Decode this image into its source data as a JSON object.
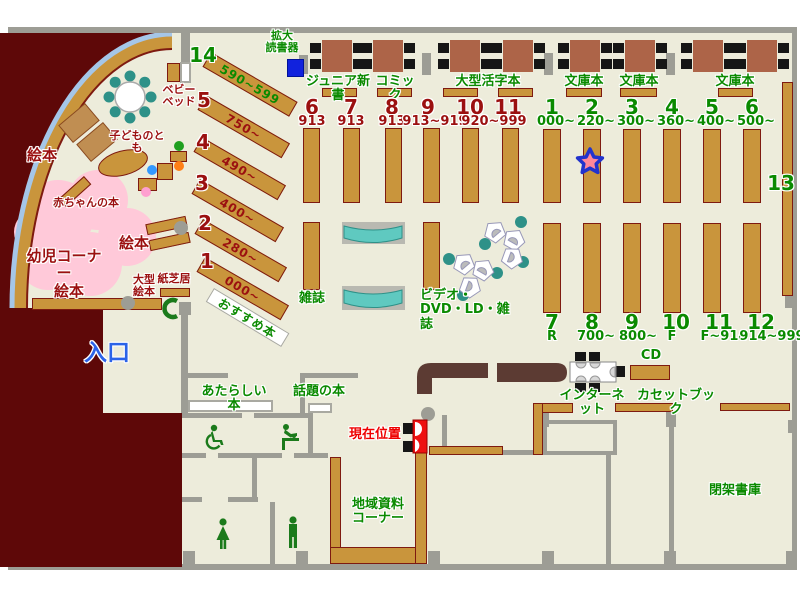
{
  "labels": {
    "kakudai": "拡大\n読書器",
    "junior": "ジュニア新書",
    "comic": "コミック",
    "ogata": "大型活字本",
    "bunko": "文庫本",
    "zasshi": "雑誌",
    "video": "ビデオ・\nDVD・LD・雑誌",
    "internet": "インターネット",
    "cd": "CD",
    "cassette": "カセットブック",
    "atarashii": "あたらしい本",
    "wadai": "話題の本",
    "chiiki": "地域資料\nコーナー",
    "heika": "閉架書庫",
    "osusume": "おすすめ本",
    "genzai": "現在位置",
    "iriguchi": "入口",
    "ehon": "絵本",
    "youji": "幼児コーナー",
    "akachan": "赤ちゃんの本",
    "kodomo": "子どものとも",
    "babybed": "ベビー\nベッド",
    "ogata_ehon": "大型\n絵本",
    "kamishibai": "紙芝居"
  },
  "left_column": {
    "top": {
      "num": "14",
      "range": "590~599"
    },
    "rows": [
      {
        "num": "5",
        "range": "750~"
      },
      {
        "num": "4",
        "range": "490~"
      },
      {
        "num": "3",
        "range": "400~"
      },
      {
        "num": "2",
        "range": "280~"
      },
      {
        "num": "1",
        "range": "000~"
      }
    ]
  },
  "mid_section": {
    "nums": [
      "6",
      "7",
      "8",
      "9",
      "10",
      "11"
    ],
    "subs": [
      "913",
      "913",
      "913",
      "913~919",
      "920~999"
    ]
  },
  "right_section": {
    "side_num": "13",
    "top_nums": [
      "1",
      "2",
      "3",
      "4",
      "5",
      "6"
    ],
    "top_ranges": [
      "000~",
      "220~",
      "300~",
      "360~",
      "400~",
      "500~"
    ],
    "bottom_nums": [
      "7",
      "8",
      "9",
      "10",
      "11",
      "12"
    ],
    "bottom_ranges": [
      "R",
      "700~",
      "800~",
      "F",
      "F~914",
      "914~999"
    ]
  },
  "icons": {
    "star_marker": "star",
    "wheelchair": "wheelchair-accessible-toilet",
    "womens_toilet": "woman",
    "mens_toilet": "man",
    "baby_change": "baby-changing",
    "public_phone": "phone-receiver-C",
    "magnifying_reader_station": "blue-square"
  },
  "colors": {
    "floor": "#EDECDB",
    "outside": "#5E0808",
    "wall": "#9D9D95",
    "shelf": "#C9953C",
    "shelf_border": "#7E1A10",
    "table": "#AD6448",
    "chair": "#161616",
    "kids_pink": "#FFC9D9",
    "arc_blue": "#A5C6E8",
    "teal_chair": "#2E9188",
    "bench_teal": "#5FC9C0",
    "counter": "#5C3B33",
    "green_text": "#0A8A00",
    "darkred_text": "#9B1010",
    "red_text": "#EE0000",
    "blue_text": "#2B63E8",
    "star_fill": "#FF8899",
    "star_border": "#2233CC",
    "reader_blue": "#1122DD",
    "icon_green": "#1B7A1B"
  }
}
